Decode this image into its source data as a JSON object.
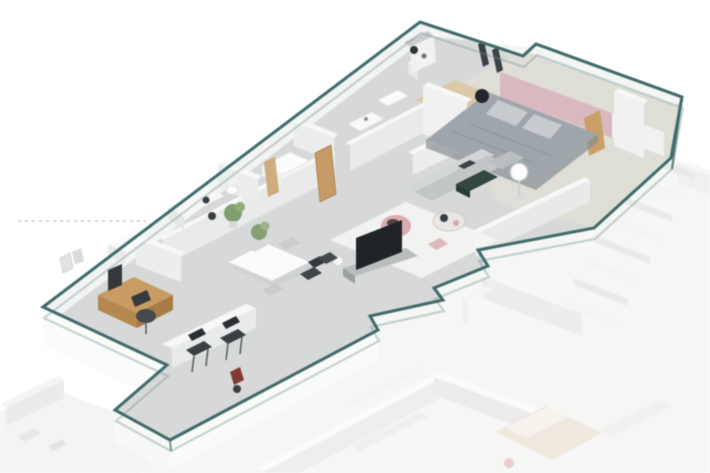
{
  "canvas": {
    "width": 710,
    "height": 473
  },
  "scene": {
    "kind": "isometric-3d-floor-plan-render",
    "unit_highlight": "teal outlined apartment unit, upper-left; faded neighbor rooms and staircase lower-right",
    "objects": [
      "unit-outline",
      "dotted-leader-line",
      "bedroom-bed",
      "bed-pillows",
      "pink-accent-wall",
      "floor-lamp",
      "window-frames",
      "sectional-sofa",
      "green-ottoman",
      "coffee-table",
      "pink-armchair",
      "pink-pouf",
      "area-rug",
      "tv-screen",
      "tv-stand",
      "dining-table",
      "dining-chairs",
      "potted-plants",
      "sideboard",
      "wooden-desk",
      "desk-monitor",
      "desk-chair",
      "office-cabinet",
      "wall-art",
      "kitchen-counter",
      "bar-stools",
      "red-accent-item",
      "shower-unit",
      "toilet",
      "sink-vanity",
      "washer",
      "storage-shelf",
      "wooden-doors",
      "neighbor-staircase",
      "neighbor-walls",
      "neighbor-bed"
    ]
  },
  "colors": {
    "background": "#ffffff",
    "outline": "#3f6b6a",
    "outline_soft": "#6f9593",
    "unit_floor": "#d7d9d8",
    "bedroom_floor": "#e0ddd6",
    "wood_floor": "#dcc49e",
    "wall_top": "#f6f7f6",
    "wall_face": "#e9ebea",
    "wall_face_bright": "#f1f2f1",
    "exterior_wall": "#fbfbfa",
    "neighbor_floor": "#f6f6f4",
    "neighbor_wall": "#ededeb",
    "stair_step_a": "#e9ebe9",
    "stair_step_b": "#f4f5f3",
    "wood": "#c99c63",
    "wood_front": "#b58850",
    "wood_side": "#a87c46",
    "wood_door": "#c59a66",
    "pink_wall": "#d9b9bf",
    "pink_chair": "#d9adb0",
    "pink_pouf": "#ddb9bb",
    "pink_neighbor": "#e9cdd0",
    "bed_duvet": "#9fa6ab",
    "bed_pillow": "#c6cbd0",
    "neighbor_bed": "#efe9e0",
    "sofa": "#c2c6c7",
    "sofa_back": "#d3d6d6",
    "dark": "#2e3338",
    "dark_green": "#31473f",
    "plant_green": "#7f9e6d",
    "plant_green_light": "#93ac7e",
    "rug": "#f4f4f2",
    "accent_red": "#7e3b33",
    "dotted_line": "#c8cac9",
    "lamp_white": "#fdfdfd",
    "gray_furniture": "#b9bdbe"
  }
}
